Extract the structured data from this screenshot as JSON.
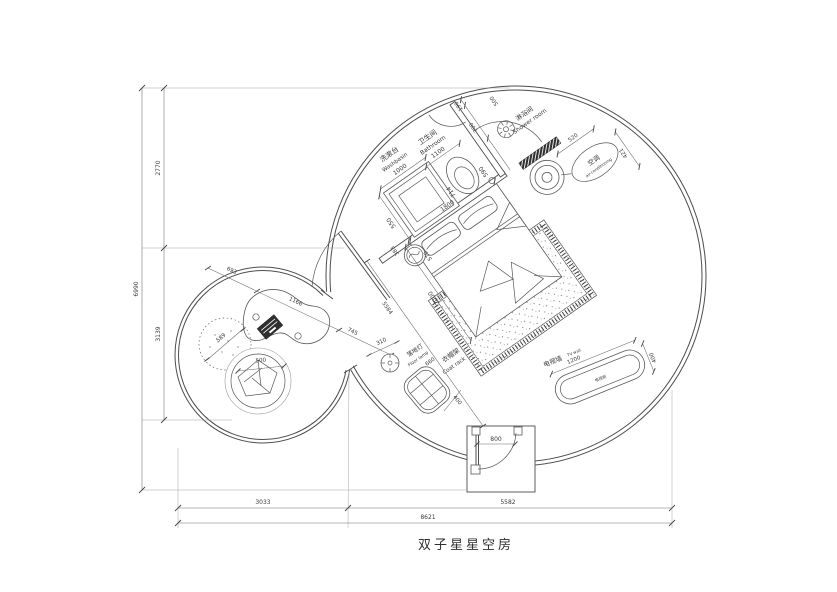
{
  "title": "双子星星空房",
  "colors": {
    "line": "#4d4d4d",
    "dim_line": "#6a6a6a",
    "text": "#3a3a3a",
    "dark_fill": "#2f2f2f",
    "background": "#ffffff"
  },
  "labels": {
    "washbasin_cn": "洗漱台",
    "washbasin_en": "Washbasin",
    "bathroom_cn": "卫生间",
    "bathroom_en": "Bathroom",
    "shower_cn": "淋浴间",
    "shower_en": "Shower room",
    "ac_cn": "空调",
    "ac_en": "air-conditioning",
    "floorlamp_cn": "落地灯",
    "floorlamp_en": "Floor lamp",
    "coatrack_cn": "衣帽架",
    "coatrack_en": "Coat rack",
    "tvwall_cn": "电视墙",
    "tvwall_en": "TV wall",
    "tvcab_cn": "电视柜"
  },
  "dims": {
    "v_total": "6990",
    "v_top": "2770",
    "v_bot": "3139",
    "h_left": "3033",
    "h_right": "5582",
    "h_total": "8621",
    "chain_a": "693",
    "chain_b": "1166",
    "chain_c": "745",
    "pouf": "589",
    "chair": "500",
    "lamp": "310",
    "coat_w": "660",
    "coat_d": "400",
    "tv_w": "1200",
    "tv_d": "400",
    "entry": "800",
    "diag": "5584",
    "bed_w": "1800",
    "bed_l": "2000",
    "stool_a": "383",
    "stool_b": "570",
    "basin_w": "1000",
    "basin_d": "550",
    "bath_w": "1100",
    "gap_toilet": "714",
    "toilet_w": "590",
    "top_a": "190",
    "top_b": "700",
    "shower_door": "500",
    "ac_a": "520",
    "ac_b": "421"
  }
}
